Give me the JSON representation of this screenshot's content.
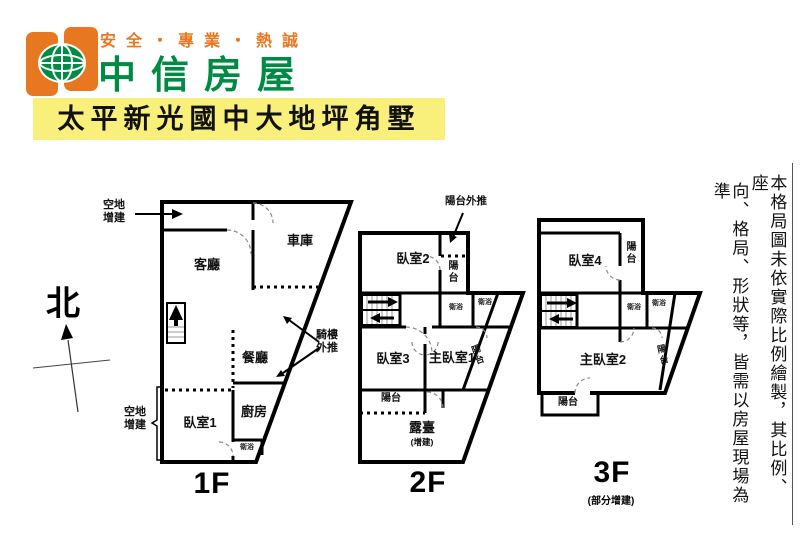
{
  "header": {
    "slogan": "安全・專業・熱誠",
    "brand": "中信房屋",
    "title": "太平新光國中大地坪角墅"
  },
  "compass": {
    "north": "北"
  },
  "disclaimer": {
    "col_right": "本格局圖未依實際比例繪製，其比例、座",
    "col_left": "向、格局、形狀等，皆需以房屋現場為準"
  },
  "floor1": {
    "label": "1F",
    "living": "客廳",
    "garage": "車庫",
    "dining": "餐廳",
    "kitchen": "廚房",
    "bedroom1": "臥室1",
    "bath": "衛浴",
    "annex_top": "空地增建",
    "annex_left": "空地增建",
    "arcade_push": "騎樓外推"
  },
  "floor2": {
    "label": "2F",
    "bedroom2": "臥室2",
    "balcony_push": "陽台外推",
    "balcony_top": "陽台",
    "bath_a": "衛浴",
    "bath_b": "衛浴",
    "bedroom3": "臥室3",
    "master1": "主臥室1",
    "balcony_side": "陽台",
    "balcony_low": "陽台",
    "terrace": "露臺",
    "terrace_note": "(增建)"
  },
  "floor3": {
    "label": "3F",
    "sublabel": "(部分增建)",
    "bedroom4": "臥室4",
    "balcony_top": "陽台",
    "bath_a": "衛浴",
    "bath_b": "衛浴",
    "master2": "主臥室2",
    "balcony_side": "陽台",
    "balcony_low": "陽台"
  },
  "colors": {
    "brand_orange": "#E87722",
    "brand_green": "#008B45",
    "title_bg": "#F8F07A",
    "wall": "#000000"
  }
}
